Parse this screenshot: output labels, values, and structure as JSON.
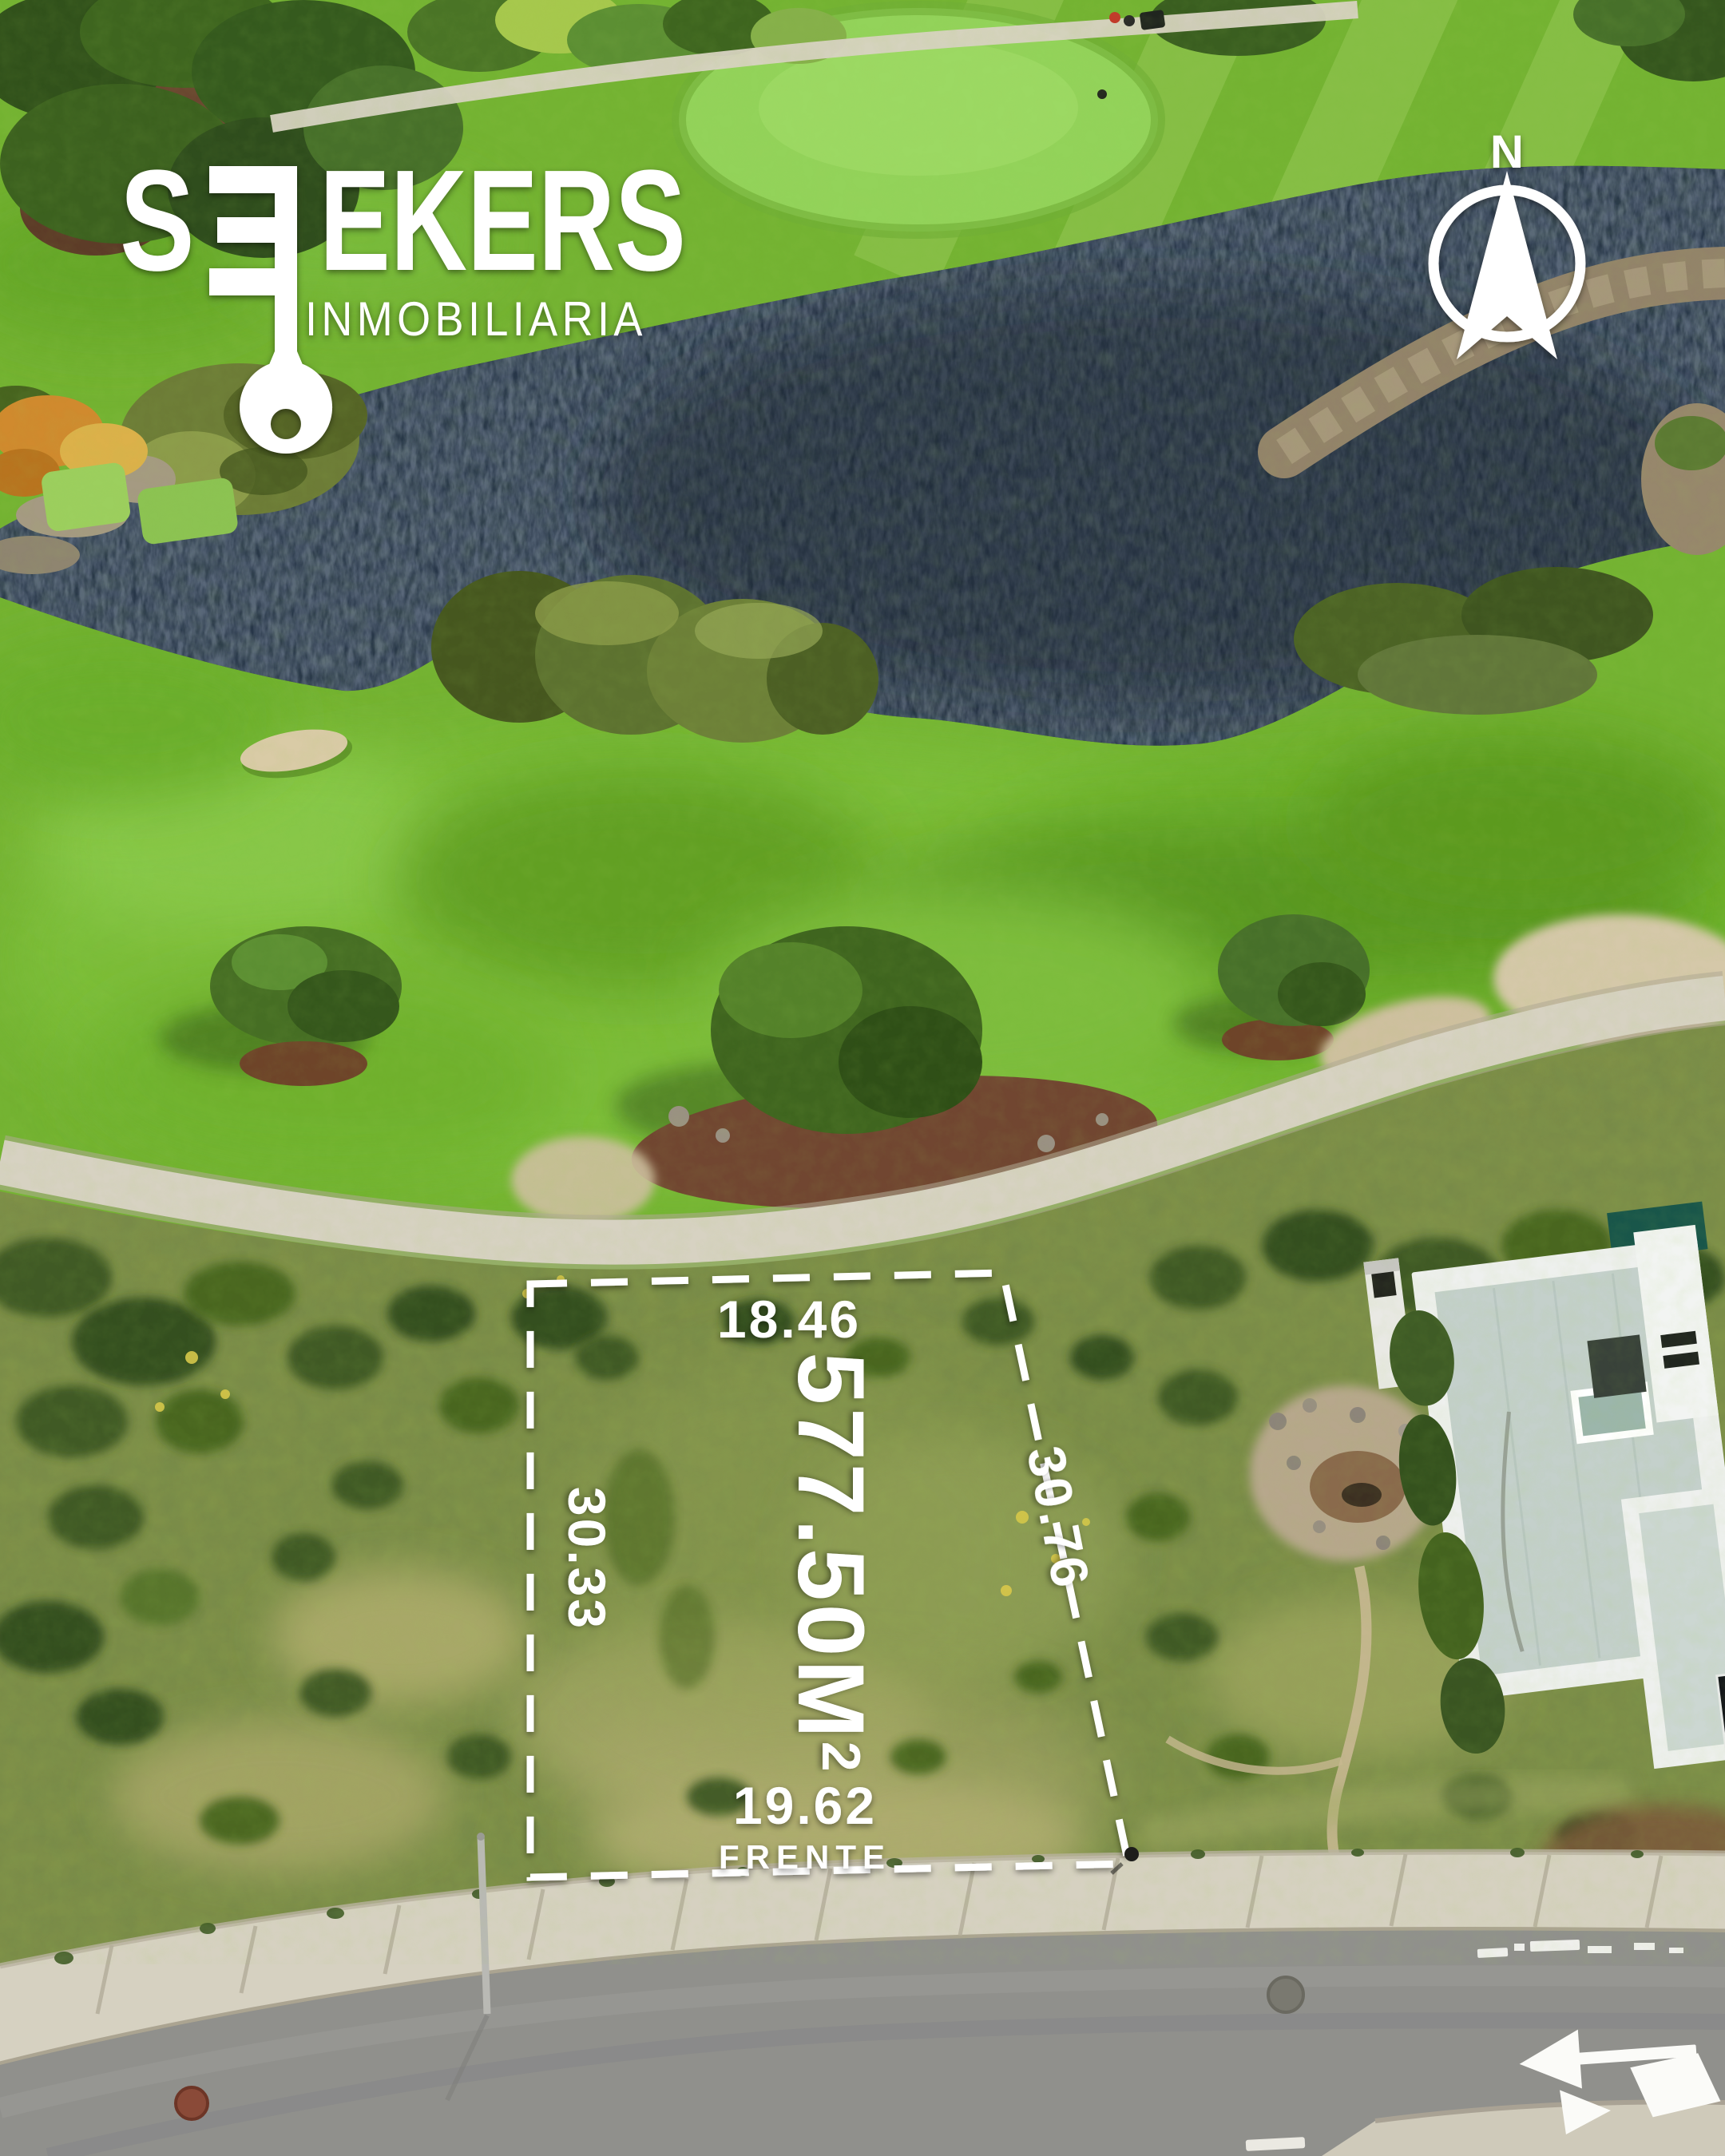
{
  "branding": {
    "logo_first": "S",
    "logo_rest": "EKERS",
    "subtitle": "INMOBILIARIA",
    "logo_icon": "key-icon"
  },
  "compass": {
    "north_label": "N",
    "icon": "north-arrow-icon"
  },
  "lot": {
    "top_measure": "18.46",
    "left_measure": "30.33",
    "right_measure": "30.76",
    "front_measure": "19.62",
    "front_label": "FRENTE",
    "area_value": "577.50M",
    "area_superscript": "2"
  },
  "colors": {
    "overlay_white": "#ffffff",
    "pond": "#22303f",
    "fairway_green": "#74b332",
    "scrub_olive": "#7f9048",
    "road_gray": "#90908c",
    "concrete": "#d6d1c1",
    "house_white": "#eef0ee",
    "roof_gray": "#c4d0cb",
    "teal_roof": "#19564a"
  }
}
